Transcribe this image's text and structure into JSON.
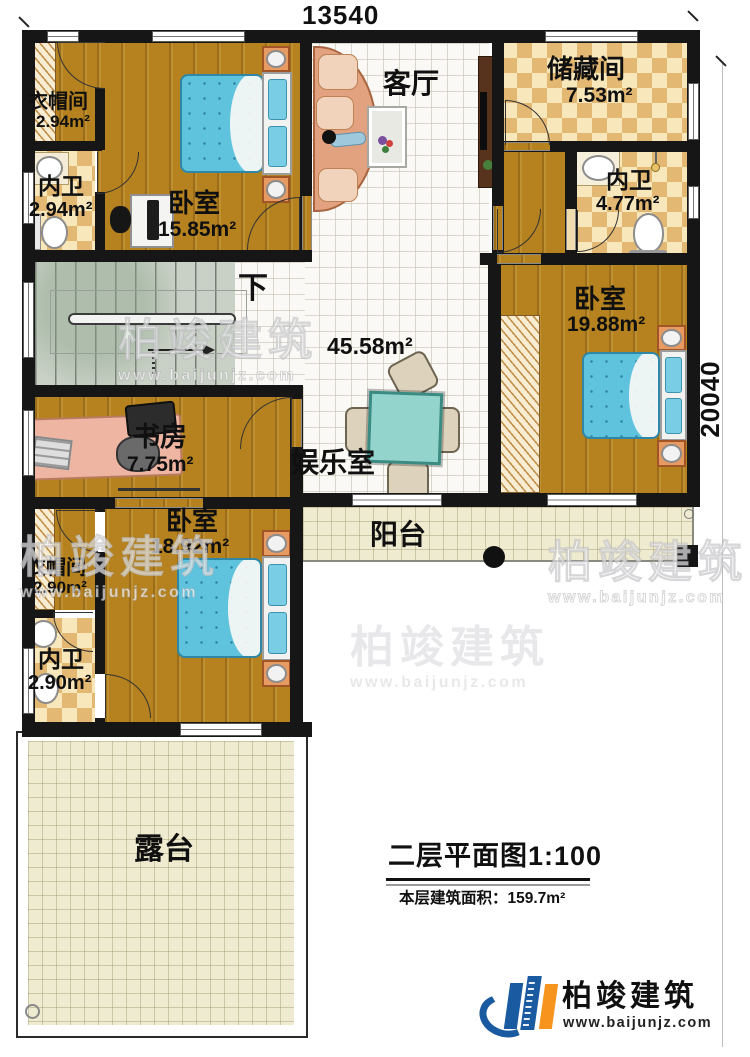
{
  "dimensions": {
    "top": "13540",
    "right": "20040"
  },
  "rooms": {
    "cloakroom_top": {
      "name": "衣帽间",
      "area": "2.94m²"
    },
    "bath_top_left": {
      "name": "内卫",
      "area": "2.94m²"
    },
    "bedroom_top": {
      "name": "卧室",
      "area": "15.85m²"
    },
    "living_room": {
      "name": "客厅"
    },
    "storage": {
      "name": "储藏间",
      "area": "7.53m²"
    },
    "bath_top_right": {
      "name": "内卫",
      "area": "4.77m²"
    },
    "bedroom_right": {
      "name": "卧室",
      "area": "19.88m²"
    },
    "entertainment": {
      "name": "娱乐室",
      "area": "45.58m²"
    },
    "study": {
      "name": "书房",
      "area": "7.75m²"
    },
    "bedroom_bottom": {
      "name": "卧室",
      "area": "18.92m²"
    },
    "cloakroom_bottom": {
      "name": "衣帽间",
      "area": "2.90m²"
    },
    "bath_bottom": {
      "name": "内卫",
      "area": "2.90m²"
    },
    "balcony": {
      "name": "阳台"
    },
    "terrace": {
      "name": "露台"
    }
  },
  "stairs": {
    "direction_label": "下"
  },
  "title_block": {
    "title": "二层平面图1:100",
    "area_prefix": "本层建筑面积：",
    "area_value": "159.7m²"
  },
  "brand": {
    "name": "柏竣建筑",
    "url": "www.baijunjz.com"
  },
  "colors": {
    "wall": "#161616",
    "wood": "#b5821f",
    "tile": "#faf9f5",
    "checker_dark": "#e3b873",
    "checker_light": "#f7e7bb",
    "bed": "#5fc3de",
    "stair": "#c9d1c6",
    "balcony": "#efebd0",
    "sofa": "#e2a17f",
    "table": "#93d5cc",
    "desk": "#eeb6a2",
    "brand_blue": "#1a5aa0",
    "brand_orange": "#f7941e"
  }
}
